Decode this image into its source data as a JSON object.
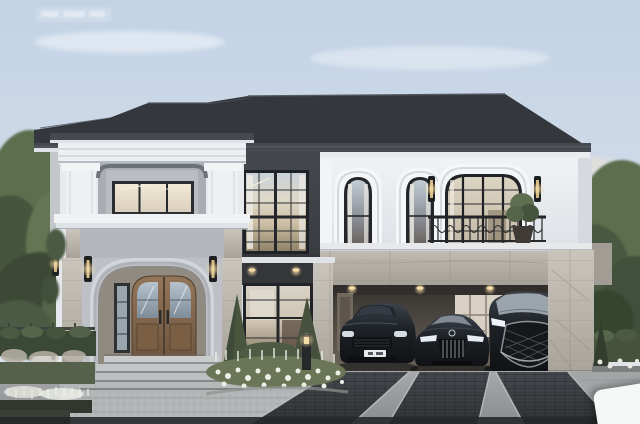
{
  "meta": {
    "kind": "architectural-exterior-rendering",
    "description": "Photorealistic dusk rendering of a two-storey modern-classic luxury house with an arched entry portico, recessed tower balcony, wrought-iron balcony, stone-clad carport with three dark luxury vehicles, paver driveway and white flower gardens"
  },
  "scene": {
    "sky": "pale blue sky with soft warm clouds near the right horizon",
    "roof": "large charcoal hip roof with white eave soffit",
    "tower": "left two-storey bay: recessed balcony with lit sliding window above an arched entry portico",
    "entry": "stepped arched portico, wooden double door with glass panels, narrow sidelight, stone steps",
    "center_section": "double-height charcoal curtain-wall with gridded windows and recessed downlights",
    "upper_right": "white upper floor with two arched windows, wall lanterns, wide gridded glass slider and black scroll balcony railing with a potted plant",
    "stone_band": "grey marble parapet/beam band with white cap running across the carport",
    "carport": "recessed carport with lit interior wall and marble corner pier",
    "vehicles": [
      "dark luxury SUV",
      "dark sedan with vertical-slat grille",
      "dark luxury minivan with spindle grille"
    ],
    "landscape": "tall trees left and right, clipped hedges, white flower beds, conical shrubs, bollard light",
    "driveway": "light concrete drive with three dark paver strips and cobble apron",
    "watermark": "faint illegible white watermark, top-left",
    "corner_badge": "partially visible white rounded card, bottom-right corner"
  },
  "colors": {
    "sky_top": "#c2d3e6",
    "sky_low": "#dde4eb",
    "cloud_warm": "#ecd9c3",
    "roof": "#34373c",
    "roof_fascia": "#45494f",
    "soffit": "#e9ebee",
    "wall_white": "#edeff2",
    "wall_gray": "#b4b8bd",
    "wall_dark": "#3e4146",
    "stone": "#b6b1a8",
    "marble_light": "#c9c4bb",
    "frame_dark": "#24262a",
    "glass_warm": "#e4dcc8",
    "glass_cool": "#c9d2da",
    "door_wood": "#8a6e50",
    "railing": "#222427",
    "car_body": "#1a1d21",
    "chrome": "#aab0b6",
    "driveway": "#9b9da0",
    "paver_dark": "#3b3d41",
    "curb_dark": "#26282a",
    "foliage_dark": "#3c4836",
    "foliage_mid": "#5c6e4e",
    "foliage_light": "#788862",
    "flower_white": "#eef0e8",
    "step_light": "#c6c8ca",
    "lamp_glow": "#f0d9a4"
  }
}
